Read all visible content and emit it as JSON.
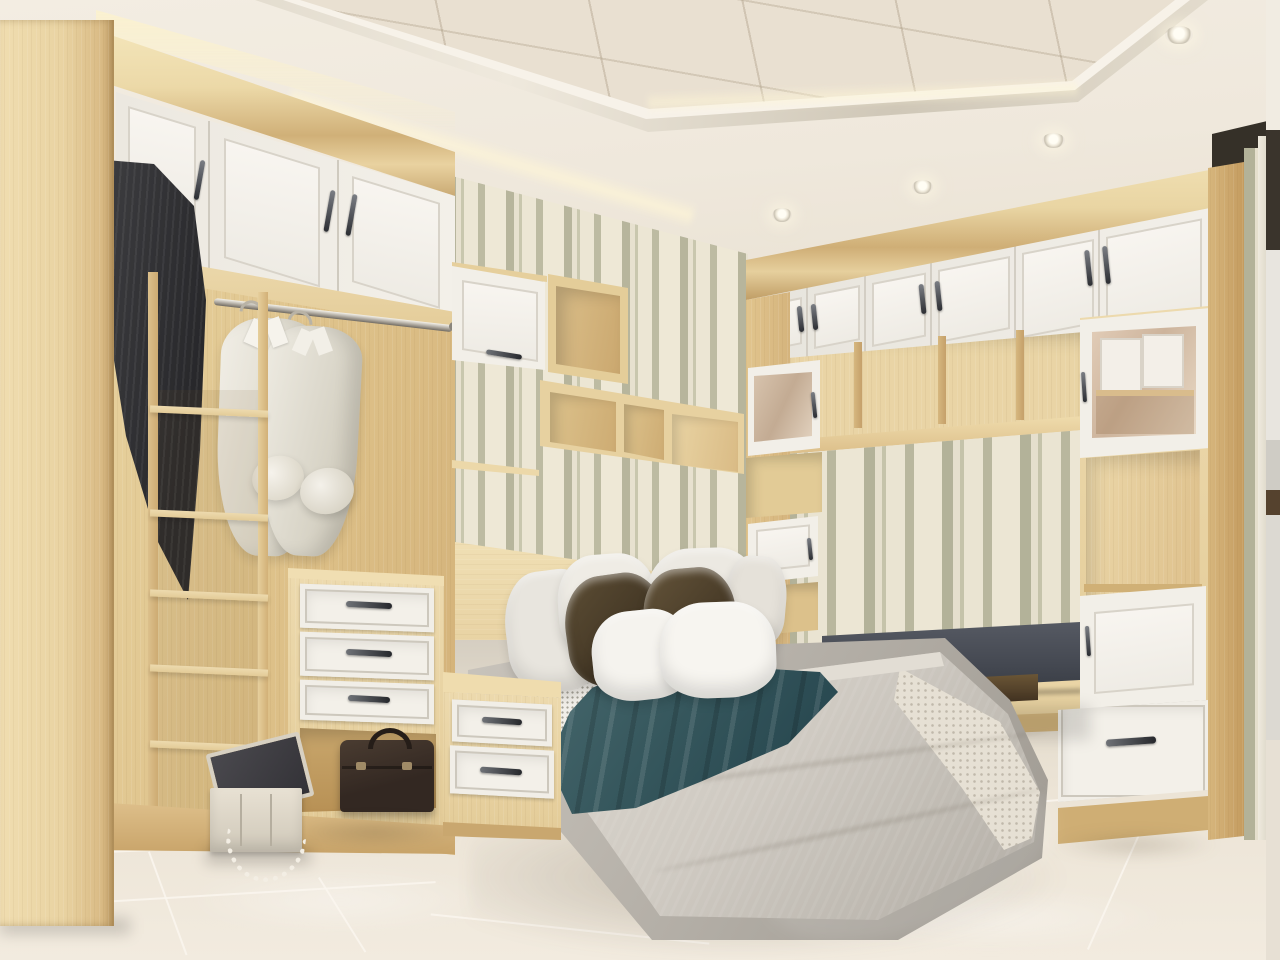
{
  "scene": {
    "type": "interior-3d-render",
    "room": "bedroom with built-in wardrobes",
    "text_present": false,
    "lighting": "warm recessed ceiling spotlights and cove lighting"
  },
  "palette": {
    "wood_light": "#ecd9ab",
    "wood_mid": "#e3cb97",
    "wood_dark": "#c9a76f",
    "cabinet_white": "#f2efe8",
    "panel_line": "#d8d3c9",
    "wallpaper_cream": "#eae4d2",
    "wallpaper_sage": "#b7b59c",
    "ceiling_cream": "#f0e9dd",
    "ceiling_tile": "#e9e0d1",
    "floor_marble": "#ece4d6",
    "bed_fabric_gray": "#c5c0b8",
    "duvet_gray": "#cfcac2",
    "blanket_teal": "#35565c",
    "pillow_white": "#f5f3ee",
    "pillow_brown": "#4f4230",
    "bench_cushion": "#474b54",
    "coat_charcoal": "#323234",
    "briefcase_brown": "#41352c",
    "handle_metal": "#3a3c40"
  },
  "objects": {
    "ceiling": {
      "style": "tray ceiling with tiled inset and molding",
      "spotlights": 5,
      "cove_glow": true
    },
    "left_wall_panel": "light wood full-height panel",
    "left_wardrobe": {
      "upper_white_doors": 3,
      "hanging_rod": 1,
      "white_shirts": 2,
      "dark_coat": 1,
      "open_shelf_column_shelves": 6,
      "drawer_tower_drawers": 3,
      "open_cubby_briefcase": 1
    },
    "center_wall": {
      "wallpaper": "vertical striped",
      "flip_up_white_cabinet": 1,
      "open_wood_cubbies": 4,
      "thin_shelf": 1,
      "wood_headboard_panel": 1
    },
    "bed": {
      "pillows_white": 6,
      "pillows_brown": 2,
      "teal_throw_blanket": 1,
      "gray_duvet": 1,
      "checkered_sheet": 1,
      "gray_upholstered_base": 1
    },
    "nightstand": {
      "drawers": 2
    },
    "jewelry_box": {
      "open_lid": true,
      "pearl_strand": true
    },
    "right_wardrobe": {
      "upper_white_doors": 6,
      "open_cubby_row_dividers": 3,
      "long_shelf": 1,
      "glass_front_cabinets": 2,
      "white_door_cabinets": 2,
      "bench_cushion": 1,
      "under_bench_slots": 2,
      "bottom_drawer": 1
    },
    "floor": "cream marble tiles with grout lines",
    "right_doorway": "glimpse of adjacent room"
  }
}
